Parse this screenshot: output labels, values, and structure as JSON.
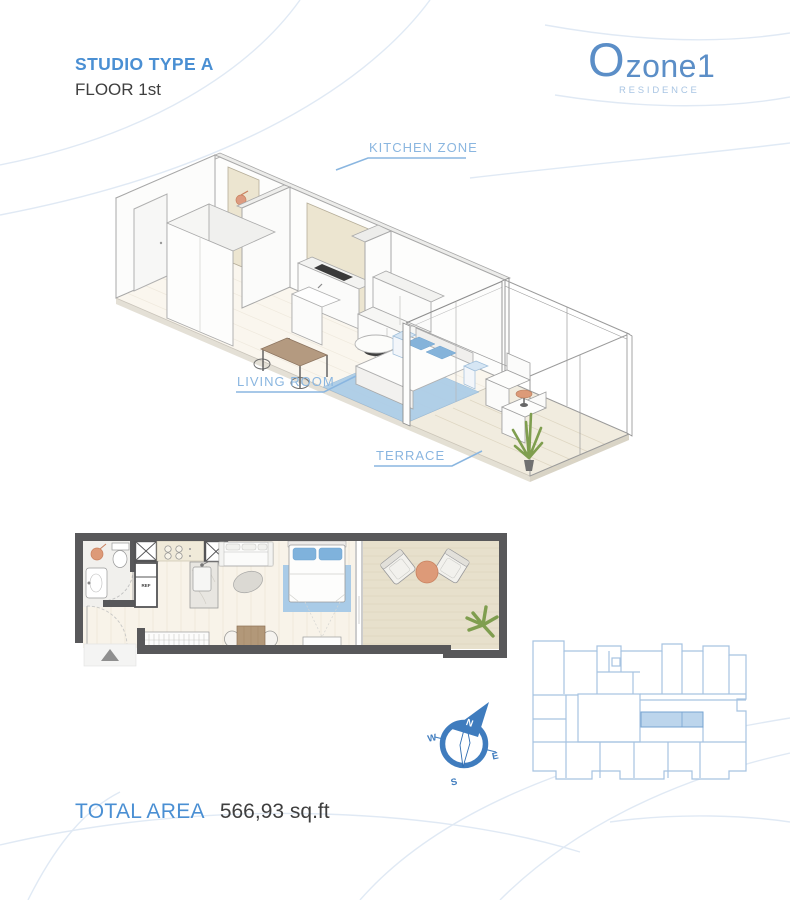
{
  "page": {
    "title": "STUDIO TYPE A",
    "subtitle": "FLOOR 1st"
  },
  "logo": {
    "brand_o": "O",
    "brand_rest": "zone1",
    "tagline": "RESIDENCE"
  },
  "iso_labels": {
    "kitchen": "KITCHEN ZONE",
    "living": "LIVING ROOM",
    "terrace": "TERRACE"
  },
  "floor_plan": {
    "ref_label": "REF"
  },
  "compass": {
    "north": "N",
    "east": "E",
    "south": "S",
    "west": "W"
  },
  "total_area": {
    "label": "TOTAL AREA",
    "value": "566,93 sq.ft"
  },
  "colors": {
    "accent_blue": "#4a8fd3",
    "label_blue": "#8ab6e0",
    "logo_blue": "#5b8ec7",
    "logo_tagline_blue": "#a9c5e3",
    "compass_blue": "#3f7cbe",
    "keyplan_line_blue": "#a6c3e1",
    "keyplan_highlight": "#bcd5ec",
    "wall_gray": "#58585a",
    "floor_cream": "#f8f3e9",
    "terrace_tan": "#e7e0cc",
    "furniture_blue": "#8bb5dc",
    "rug_blue": "#a9cbe7",
    "wood_orange": "#dd9a78",
    "plant_green": "#7f9e4f",
    "text_dark": "#3f3f3f",
    "background_arc": "#dbe6f3"
  }
}
